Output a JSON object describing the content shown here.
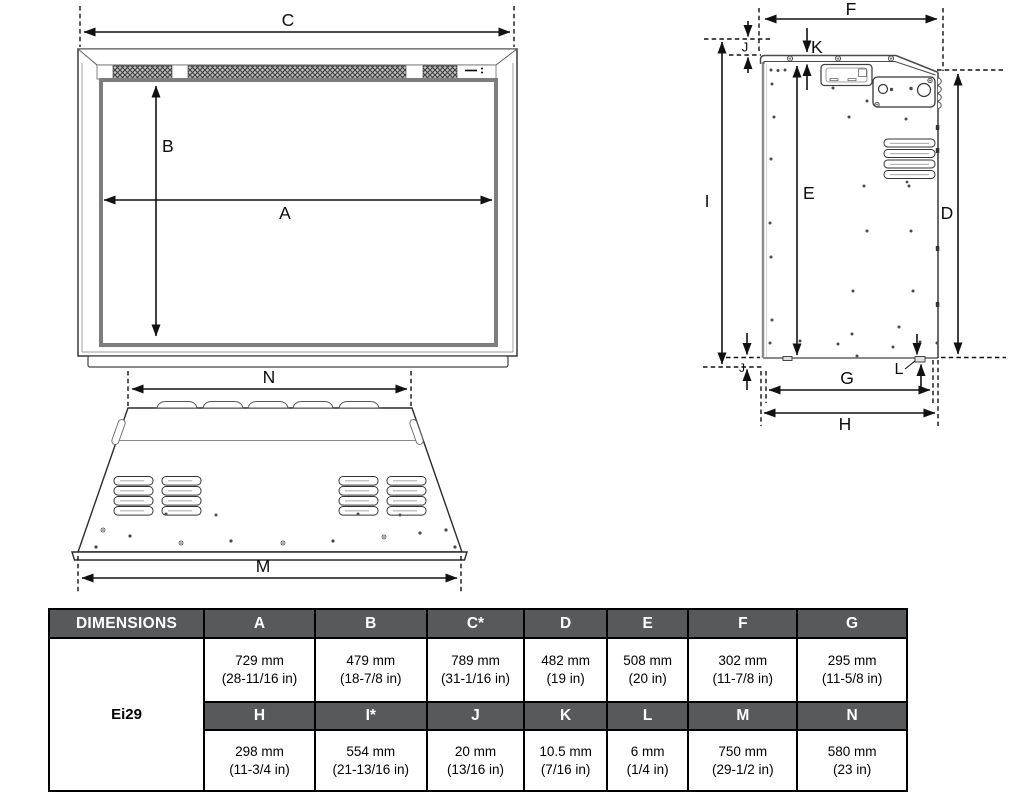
{
  "labels": {
    "front": {
      "c": "C",
      "b": "B",
      "a": "A"
    },
    "side": {
      "f": "F",
      "k": "K",
      "j_top": "J",
      "i": "I",
      "e": "E",
      "d": "D",
      "j_bottom": "J",
      "l": "L",
      "g": "G",
      "h": "H"
    },
    "rear": {
      "n": "N",
      "m": "M"
    }
  },
  "table": {
    "corner": "DIMENSIONS",
    "model": "Ei29",
    "row1_headers": [
      "A",
      "B",
      "C*",
      "D",
      "E",
      "F",
      "G"
    ],
    "row1_values": [
      {
        "mm": "729 mm",
        "in": "(28-11/16 in)"
      },
      {
        "mm": "479 mm",
        "in": "(18-7/8 in)"
      },
      {
        "mm": "789 mm",
        "in": "(31-1/16 in)"
      },
      {
        "mm": "482 mm",
        "in": "(19 in)"
      },
      {
        "mm": "508 mm",
        "in": "(20 in)"
      },
      {
        "mm": "302 mm",
        "in": "(11-7/8 in)"
      },
      {
        "mm": "295 mm",
        "in": "(11-5/8 in)"
      }
    ],
    "row2_headers": [
      "H",
      "I*",
      "J",
      "K",
      "L",
      "M",
      "N"
    ],
    "row2_values": [
      {
        "mm": "298 mm",
        "in": "(11-3/4 in)"
      },
      {
        "mm": "554 mm",
        "in": "(21-13/16 in)"
      },
      {
        "mm": "20 mm",
        "in": "(13/16 in)"
      },
      {
        "mm": "10.5 mm",
        "in": "(7/16 in)"
      },
      {
        "mm": "6 mm",
        "in": "(1/4 in)"
      },
      {
        "mm": "750 mm",
        "in": "(29-1/2 in)"
      },
      {
        "mm": "580 mm",
        "in": "(23 in)"
      }
    ]
  },
  "colors": {
    "table_header_bg": "#58595b",
    "table_header_text": "#ffffff",
    "line": "#111111"
  }
}
